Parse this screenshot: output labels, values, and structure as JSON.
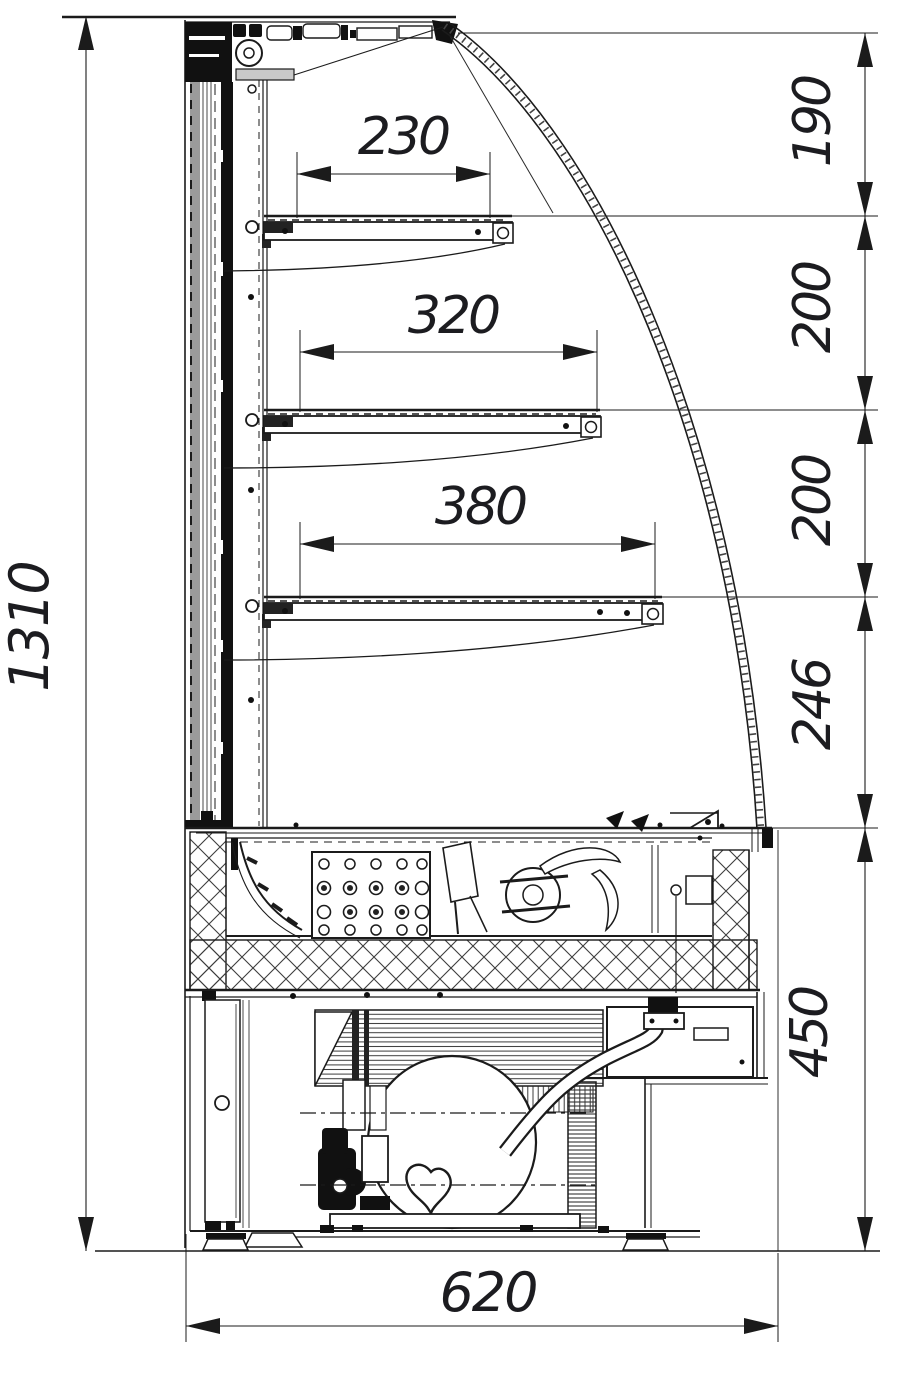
{
  "drawing": {
    "type": "technical-section",
    "subject": "Curved-glass refrigerated display case, side cross-section",
    "units": "mm"
  },
  "dims": {
    "total_height": "1310",
    "total_depth": "620",
    "seg_top": "190",
    "seg_upper": "200",
    "seg_middle": "200",
    "seg_lower": "246",
    "seg_base": "450",
    "shelf_top": "230",
    "shelf_middle": "320",
    "shelf_bottom": "380"
  },
  "colors": {
    "line": "#1b1b1b",
    "wall_gray": "#9b9b9b",
    "background": "#ffffff"
  }
}
